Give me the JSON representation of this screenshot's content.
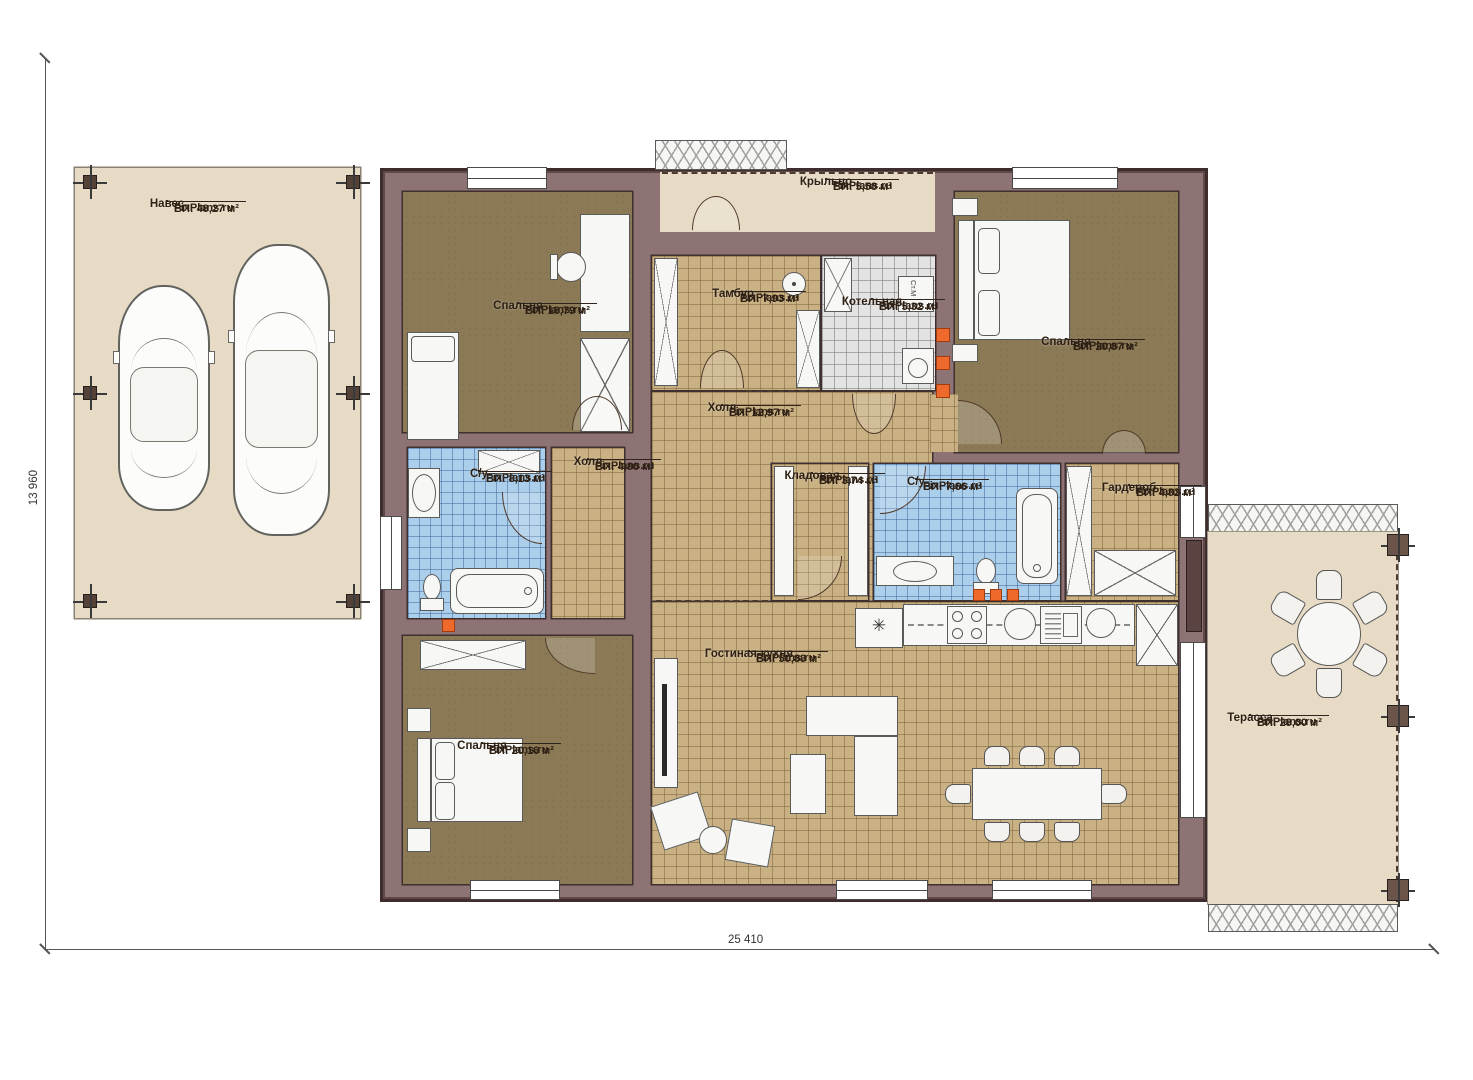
{
  "meta": {
    "brand": "FixPlans.ru",
    "plan_type": "floor-plan"
  },
  "dimensions": {
    "width": "25 410",
    "height": "13 960"
  },
  "rooms": {
    "naves": {
      "name": "Навес",
      "brand": "FixPlans.ru",
      "area": "ВП: 48,27 м²"
    },
    "kryltso": {
      "name": "Крыльцо",
      "brand": "FixPlans.ru",
      "area": "ВП: 5,58 м²"
    },
    "spalnya1": {
      "name": "Спальня",
      "brand": "FixPlans.ru",
      "area": "ВП: 18,79 м²"
    },
    "tambur": {
      "name": "Тамбур",
      "brand": "FixPlans.ru",
      "area": "ВП: 7,93 м²"
    },
    "kotelnaya": {
      "name": "Котельная",
      "brand": "FixPlans.ru",
      "area": "ВП: 5,32 м²"
    },
    "spalnya2": {
      "name": "Спальня",
      "brand": "FixPlans.ru",
      "area": "ВП: 20,87 м²"
    },
    "holl": {
      "name": "Холл",
      "brand": "FixPlans.ru",
      "area": "ВП: 12,97 м²"
    },
    "su1": {
      "name": "С/у",
      "brand": "FixPlans.ru",
      "area": "ВП: 8,13 м²"
    },
    "holl2": {
      "name": "Холл",
      "brand": "FixPlans.ru",
      "area": "ВП: 4,80 м²"
    },
    "kladovaya": {
      "name": "Кладовая",
      "brand": "FixPlans.ru",
      "area": "ВП: 3,74 м²"
    },
    "su2": {
      "name": "С/у",
      "brand": "FixPlans.ru",
      "area": "ВП: 7,66 м²"
    },
    "garderob": {
      "name": "Гардероб",
      "brand": "FixPlans.ru",
      "area": "ВП: 4,82 м²"
    },
    "spalnya3": {
      "name": "Спальня",
      "brand": "FixPlans.ru",
      "area": "ВП: 20,16 м²"
    },
    "gostinaya": {
      "name": "Гостиная-кухня",
      "brand": "FixPlans.ru",
      "area": "ВП: 50,88 м²"
    },
    "terassa": {
      "name": "Терасса",
      "brand": "FixPlans.ru",
      "area": "ВП: 28,00 м²"
    }
  },
  "appliances": {
    "washing_machine": "Ст.М",
    "fridge_symbol": "✳"
  },
  "colors": {
    "wall": "#8d7373",
    "floor_wood": "#8c7a56",
    "tile_tan": "#c9b184",
    "tile_blue": "#abceea",
    "tile_grey": "#e3e3e3",
    "outdoor": "#e7dbc5",
    "outlet_accent": "#ed6a2c"
  }
}
